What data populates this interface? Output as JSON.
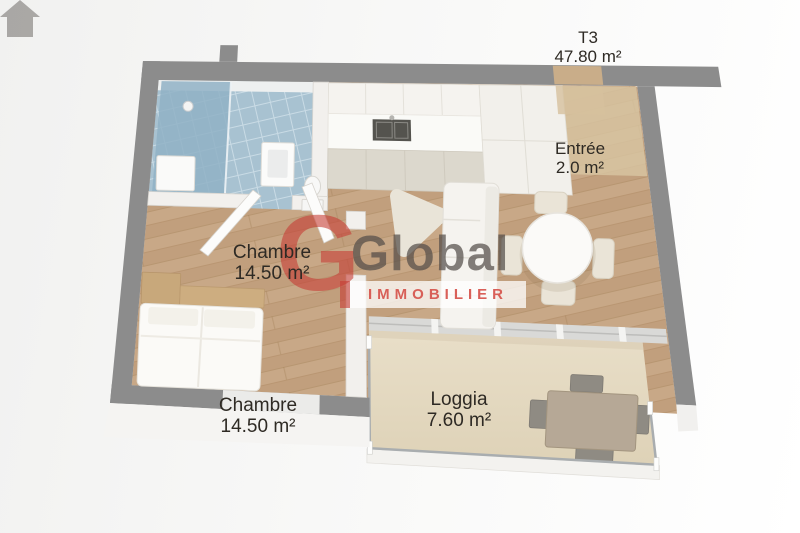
{
  "title": {
    "type": "T3",
    "area": "47.80 m²"
  },
  "labels": {
    "entree": {
      "name": "Entrée",
      "area": "2.0 m²"
    },
    "chambre_top": {
      "name": "Chambre",
      "area": "14.50 m²"
    },
    "chambre_bottom": {
      "name": "Chambre",
      "area": "14.50 m²"
    },
    "loggia": {
      "name": "Loggia",
      "area": "7.60 m²"
    }
  },
  "watermark": {
    "monogram": "G",
    "brand": "Global",
    "tagline": "IMMOBILIER"
  },
  "colors": {
    "brand_red": "#c73e36",
    "brand_gray": "#544e4a",
    "wall_gray": "#8c8c8c",
    "wood_floor": "#c8a887",
    "bathroom_tile": "#a8c2d1",
    "loggia_floor": "#e7dcc5"
  }
}
